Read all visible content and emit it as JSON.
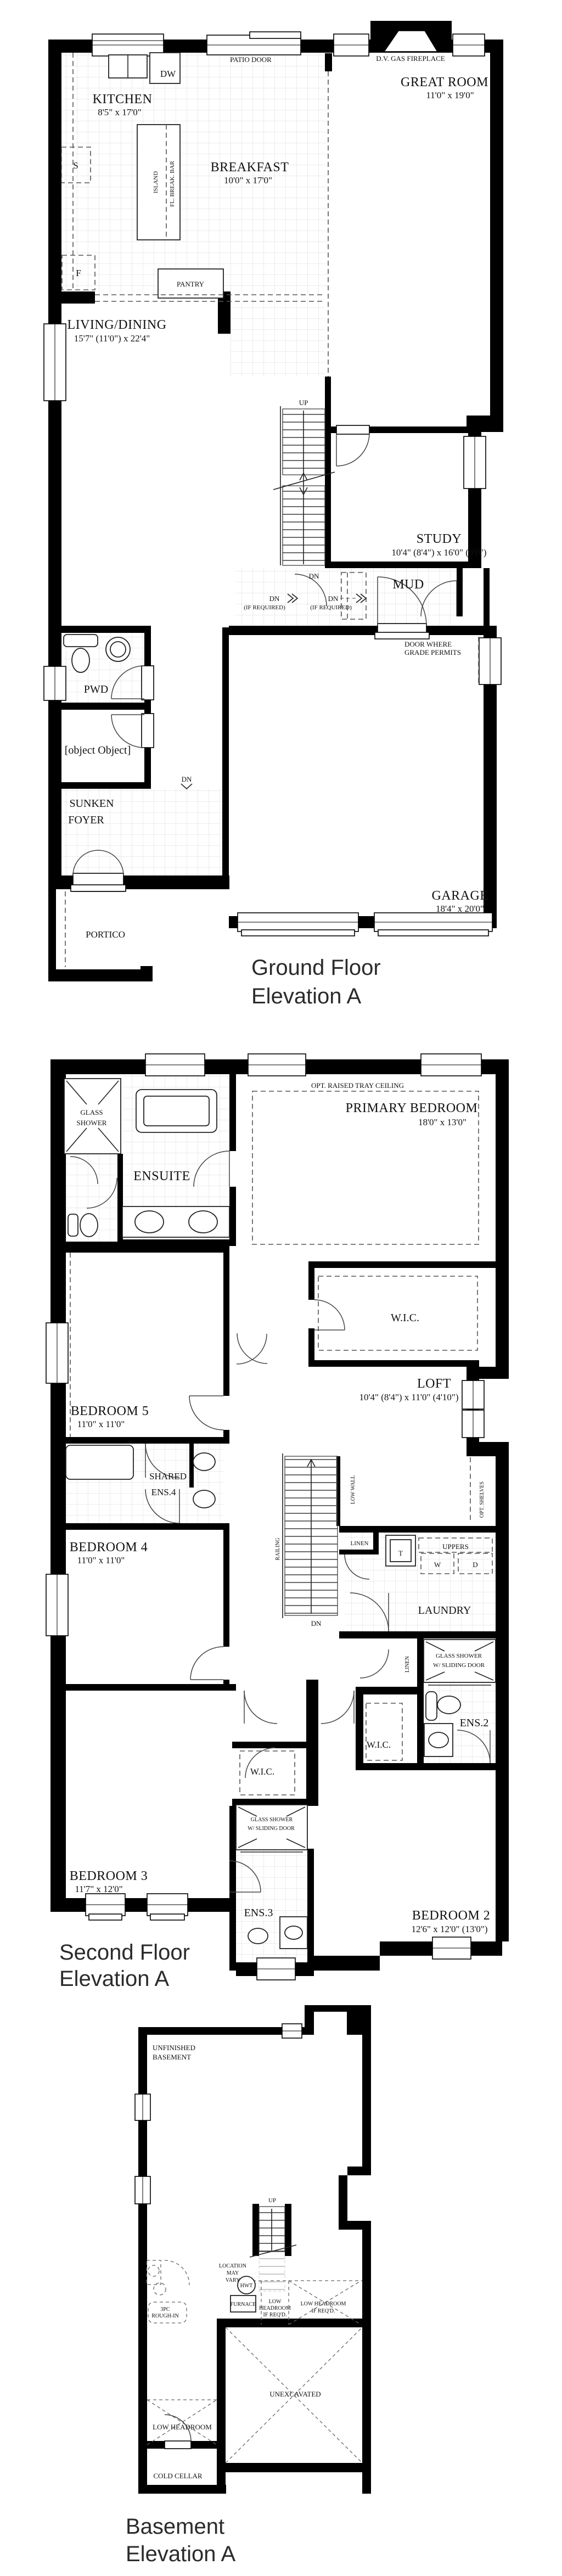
{
  "ground": {
    "title1": "Ground Floor",
    "title2": "Elevation A",
    "rooms": {
      "kitchen": {
        "name": "KITCHEN",
        "dim": "8'5\" x 17'0\""
      },
      "great": {
        "name": "GREAT ROOM",
        "dim": "11'0\" x 19'0\""
      },
      "breakfast": {
        "name": "BREAKFAST",
        "dim": "10'0\" x 17'0\""
      },
      "living": {
        "name": "LIVING/DINING",
        "dim": "15'7\" (11'0\") x 22'4\""
      },
      "study": {
        "name": "STUDY",
        "dim": "10'4\" (8'4\") x 16'0\" (9'0\")"
      },
      "mud": {
        "name": "MUD"
      },
      "pwd": {
        "name": "PWD"
      },
      "wic": {
        "name": "W.I.C."
      },
      "foyer1": "SUNKEN",
      "foyer2": "FOYER",
      "portico": {
        "name": "PORTICO"
      },
      "garage": {
        "name": "GARAGE",
        "dim": "18'4\" x 20'0\""
      }
    },
    "ann": {
      "patio_door": "PATIO DOOR",
      "dw": "DW",
      "s": "S",
      "f": "F",
      "island": "ISLAND",
      "break_bar": "FL. BREAK. BAR",
      "fireplace": "D.V. GAS FIREPLACE",
      "pantry": "PANTRY",
      "up": "UP",
      "dn": "DN",
      "if_required": "(IF REQUIRED)",
      "door_grade1": "DOOR WHERE",
      "door_grade2": "GRADE PERMITS"
    }
  },
  "second": {
    "title1": "Second Floor",
    "title2": "Elevation A",
    "rooms": {
      "primary": {
        "name": "PRIMARY BEDROOM",
        "dim": "18'0\" x 13'0\""
      },
      "ensuite": {
        "name": "ENSUITE"
      },
      "wic": "W.I.C.",
      "loft": {
        "name": "LOFT",
        "dim": "10'4\" (8'4\") x 11'0\" (4'10\")"
      },
      "bed5": {
        "name": "BEDROOM 5",
        "dim": "11'0\" x 11'0\""
      },
      "ens4a": "SHARED",
      "ens4b": "ENS.4",
      "bed4": {
        "name": "BEDROOM 4",
        "dim": "11'0\" x 11'0\""
      },
      "laundry": "LAUNDRY",
      "linen": "LINEN",
      "ens2": "ENS.2",
      "ens3": "ENS.3",
      "bed3": {
        "name": "BEDROOM 3",
        "dim": "11'7\" x 12'0\""
      },
      "bed2": {
        "name": "BEDROOM 2",
        "dim": "12'6\" x 12'0\" (13'0\")"
      }
    },
    "ann": {
      "glass1": "GLASS",
      "glass2": "SHOWER",
      "tray": "OPT. RAISED TRAY CEILING",
      "low_wall": "LOW WALL",
      "opt_shelves": "OPT. SHELVES",
      "railing": "RAILING",
      "uppers": "UPPERS",
      "w": "W",
      "d": "D",
      "t": "T",
      "dn": "DN",
      "slide1": "GLASS SHOWER",
      "slide2": "W/ SLIDING DOOR"
    }
  },
  "basement": {
    "title1": "Basement",
    "title2": "Elevation A",
    "labels": {
      "unf1": "UNFINISHED",
      "unf2": "BASEMENT",
      "up": "UP",
      "loc1": "LOCATION",
      "loc2": "MAY",
      "loc3": "VARY",
      "hwt": "HWT",
      "furnace": "FURNACE",
      "lh1": "LOW",
      "lh2": "HEADROOM",
      "lh3": "IF REQ'D.",
      "lhb1": "LOW HEADROOM",
      "lhb2": "IF REQ'D.",
      "r1": "3PC",
      "r2": "ROUGH-IN",
      "unex": "UNEXCAVATED",
      "lowhead": "LOW HEADROOM",
      "cold": "COLD CELLAR"
    }
  }
}
